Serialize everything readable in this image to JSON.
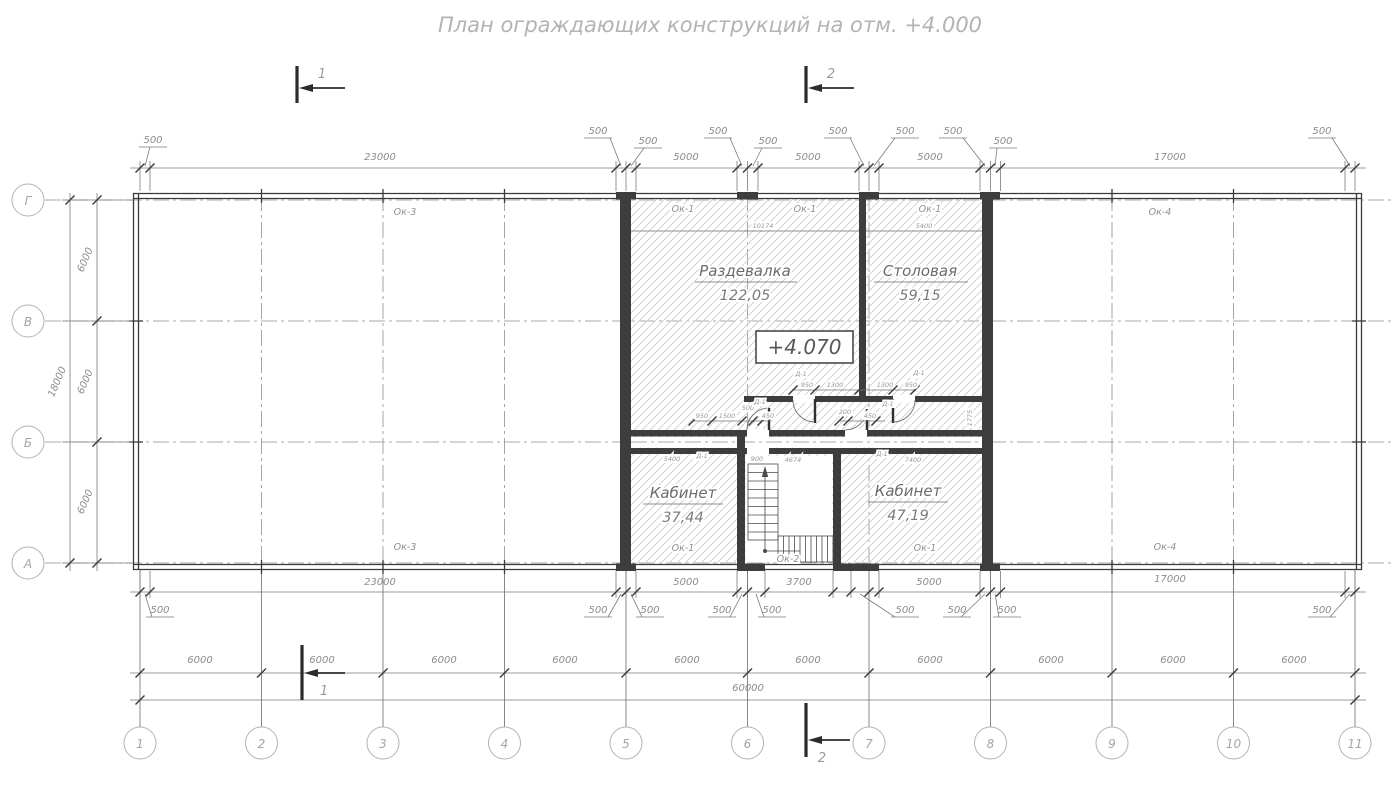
{
  "title": "План ограждающих конструкций на отм. +4.000",
  "sections": {
    "one": "1",
    "two": "2"
  },
  "axes": {
    "rows": [
      "Г",
      "В",
      "Б",
      "А"
    ],
    "cols": [
      "1",
      "2",
      "3",
      "4",
      "5",
      "6",
      "7",
      "8",
      "9",
      "10",
      "11"
    ]
  },
  "dims": {
    "d500": "500",
    "d23000": "23000",
    "d5000": "5000",
    "d17000": "17000",
    "d3700": "3700",
    "d6000": "6000",
    "d18000": "18000",
    "d60000": "60000"
  },
  "marks": {
    "ok1": "Ок-1",
    "ok2": "Ок-2",
    "ok3": "Ок-3",
    "ok4": "Ок-4",
    "d1": "Д-1"
  },
  "rooms": {
    "razdevalka": {
      "name": "Раздевалка",
      "area": "122,05"
    },
    "stolovaya": {
      "name": "Столовая",
      "area": "59,15"
    },
    "kabinet1": {
      "name": "Кабинет",
      "area": "37,44"
    },
    "kabinet2": {
      "name": "Кабинет",
      "area": "47,19"
    }
  },
  "elevation": "+4.070",
  "small": {
    "s10174": "10174",
    "s5400": "5400",
    "s4674": "4674",
    "s7400": "7400",
    "s950": "950",
    "s1300": "1300",
    "s1500": "1500",
    "s500": "500",
    "s450": "450",
    "s200": "200",
    "s900": "900",
    "s1775": "1775"
  }
}
